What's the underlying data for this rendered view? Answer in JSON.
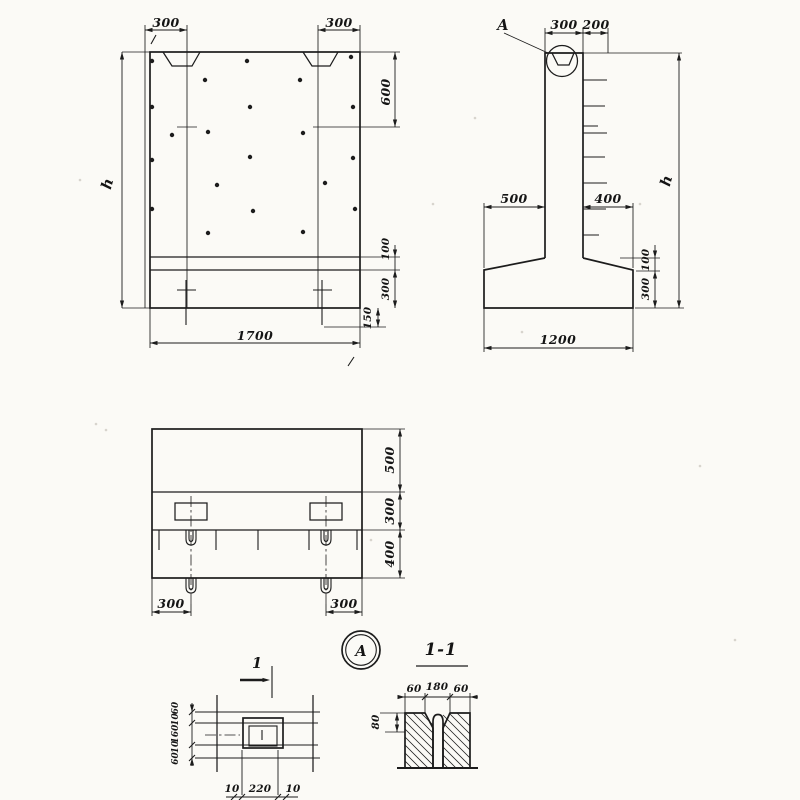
{
  "theme": {
    "paper": "#fbfaf6",
    "ink": "#1c1c1c"
  },
  "front_view": {
    "dim_notch_left": "300",
    "dim_notch_right": "300",
    "dim_height": "h",
    "dim_top": "600",
    "dim_band_thin": "100",
    "dim_band": "300",
    "dim_anchor": "150",
    "dim_width": "1700"
  },
  "side_view": {
    "callout": "А",
    "dim_stem": "300",
    "dim_offset": "200",
    "dim_height": "h",
    "dim_toe_left": "500",
    "dim_toe_right": "400",
    "dim_haunch": "100",
    "dim_base": "300",
    "dim_width": "1200"
  },
  "plan_view": {
    "dim_top": "500",
    "dim_mid": "300",
    "dim_bottom": "400",
    "dim_anchor_left": "300",
    "dim_anchor_right": "300"
  },
  "pocket_detail": {
    "cut_label": "1",
    "side_dims": [
      "60",
      "10",
      "160",
      "10",
      "60"
    ],
    "bottom_dims": [
      "10",
      "220",
      "10"
    ]
  },
  "detail_marker": {
    "label": "А"
  },
  "section_view": {
    "title": "1-1",
    "width_dims": [
      "60",
      "180",
      "60"
    ],
    "dim_depth": "80"
  }
}
